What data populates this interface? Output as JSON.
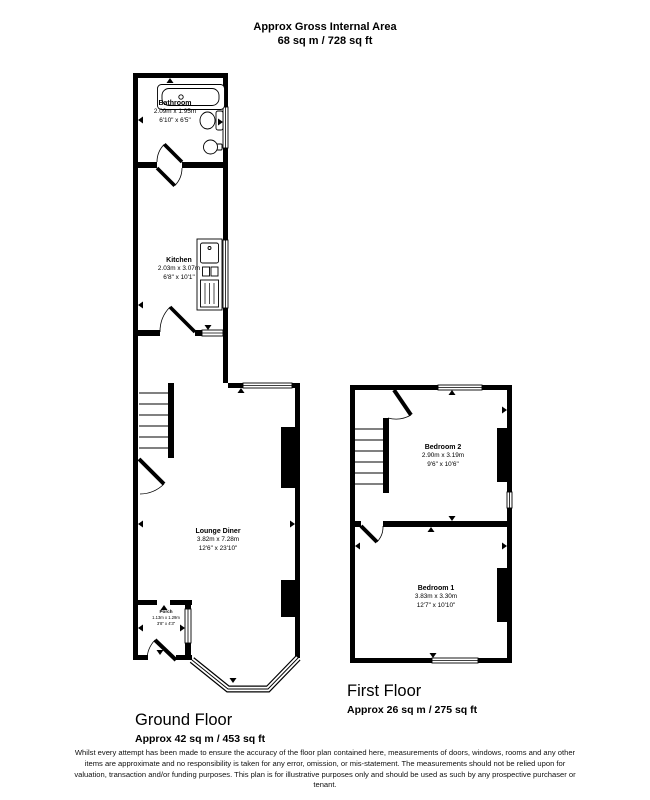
{
  "header": {
    "title": "Approx Gross Internal Area",
    "subtitle": "68 sq m / 728 sq ft"
  },
  "ground_floor": {
    "caption": "Ground Floor",
    "area": "Approx 42 sq m / 453 sq ft",
    "rooms": {
      "bathroom": {
        "name": "Bathroom",
        "metric": "2.09m x 1.95m",
        "imperial": "6'10\" x 6'5\""
      },
      "kitchen": {
        "name": "Kitchen",
        "metric": "2.03m x 3.07m",
        "imperial": "6'8\" x 10'1\""
      },
      "lounge_diner": {
        "name": "Lounge Diner",
        "metric": "3.82m x 7.28m",
        "imperial": "12'6\" x 23'10\""
      },
      "porch": {
        "name": "Porch",
        "metric": "1.13m x 1.29m",
        "imperial": "3'8\" x 4'3\""
      }
    }
  },
  "first_floor": {
    "caption": "First Floor",
    "area": "Approx 26 sq m / 275 sq ft",
    "rooms": {
      "bedroom2": {
        "name": "Bedroom 2",
        "metric": "2.90m x 3.19m",
        "imperial": "9'6\" x 10'6\""
      },
      "bedroom1": {
        "name": "Bedroom 1",
        "metric": "3.83m x 3.30m",
        "imperial": "12'7\" x 10'10\""
      }
    }
  },
  "disclaimer": "Whilst every attempt has been made to ensure the accuracy of the floor plan contained here, measurements of doors, windows, rooms and any other items are approximate and no responsibility is taken for any error, omission, or mis-statement. The measurements should not be relied upon for valuation, transaction and/or funding purposes. This plan is for illustrative purposes only and should be used as such by any prospective purchaser or tenant.",
  "colors": {
    "walls": "#000000",
    "background": "#ffffff"
  },
  "icons": {
    "bathtub": "rounded-rect",
    "toilet": "ellipse-with-cistern",
    "basin": "circle",
    "kitchen-sink-unit": "rect-with-bowls-and-drainer",
    "stairs": "tread-lines",
    "door": "leaf-and-quarter-arc",
    "window": "double-line-band",
    "dimension-arrow": "small-triangle"
  }
}
